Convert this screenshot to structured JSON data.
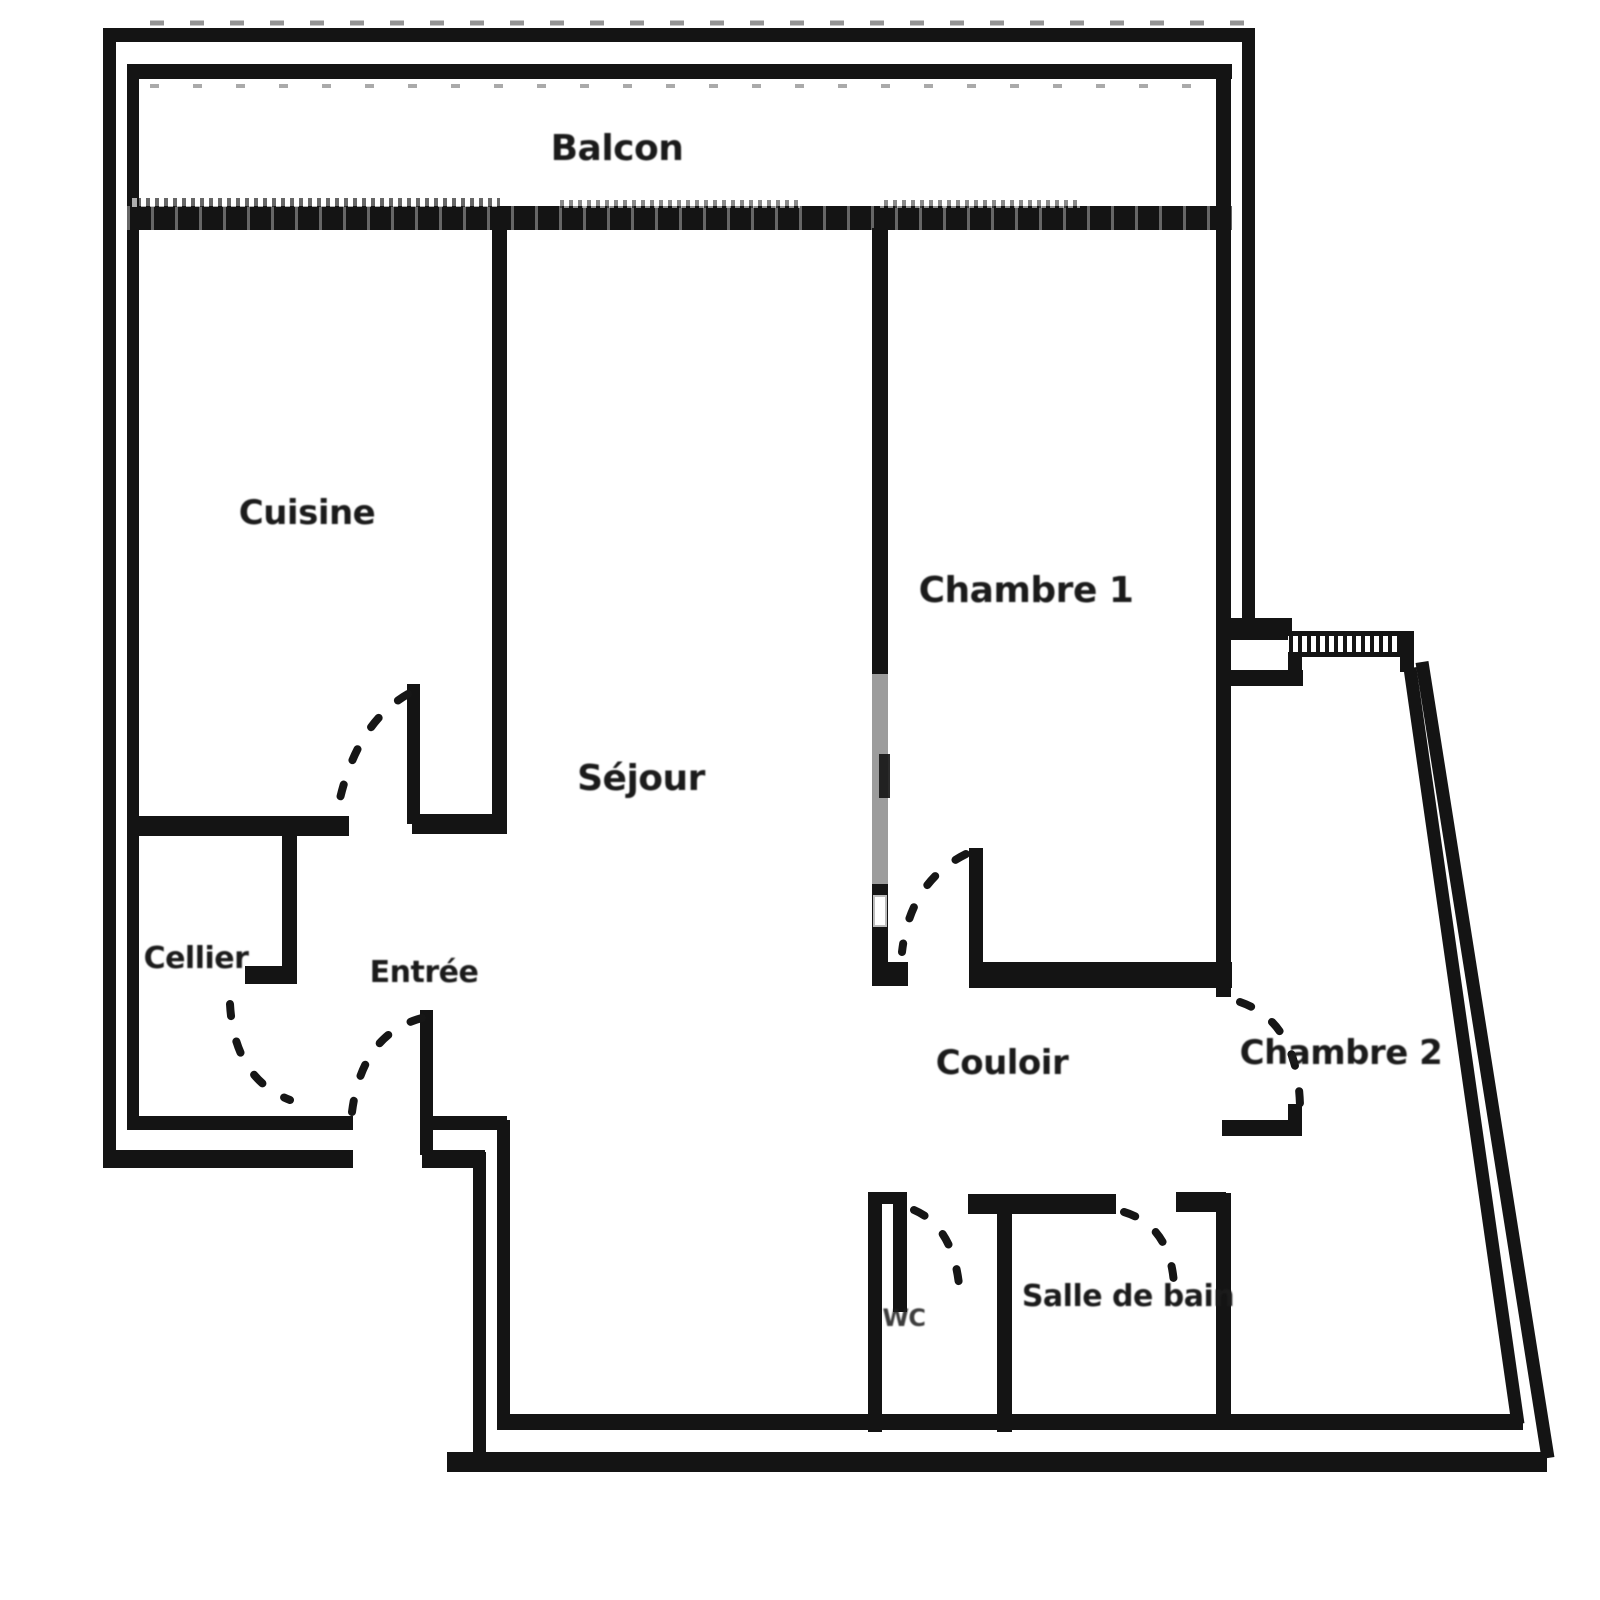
{
  "floor_plan": {
    "rooms": [
      {
        "id": "balcon",
        "label": "Balcon"
      },
      {
        "id": "cuisine",
        "label": "Cuisine"
      },
      {
        "id": "sejour",
        "label": "Séjour"
      },
      {
        "id": "chambre-1",
        "label": "Chambre 1"
      },
      {
        "id": "cellier",
        "label": "Cellier"
      },
      {
        "id": "entree",
        "label": "Entrée"
      },
      {
        "id": "couloir",
        "label": "Couloir"
      },
      {
        "id": "chambre-2",
        "label": "Chambre 2"
      },
      {
        "id": "wc",
        "label": "WC"
      },
      {
        "id": "salle-de-bain",
        "label": "Salle de bain"
      }
    ],
    "colors": {
      "ink": "#141414",
      "faded_wall": "#9c9c9c",
      "paper": "#ffffff"
    }
  }
}
